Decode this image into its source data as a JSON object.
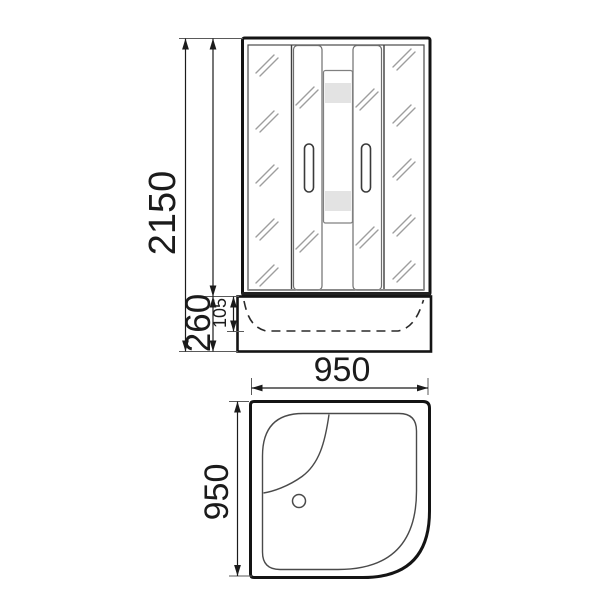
{
  "colors": {
    "background": "#ffffff",
    "line": "#1b1b1b",
    "glass_hatch": "#9e9e9e",
    "frosted_band": "#e3e3e3"
  },
  "front_view": {
    "dim_total_height": "2150",
    "dim_tray_height": "260",
    "dim_basin_depth": "105"
  },
  "top_view": {
    "dim_width": "950",
    "dim_depth": "950"
  }
}
